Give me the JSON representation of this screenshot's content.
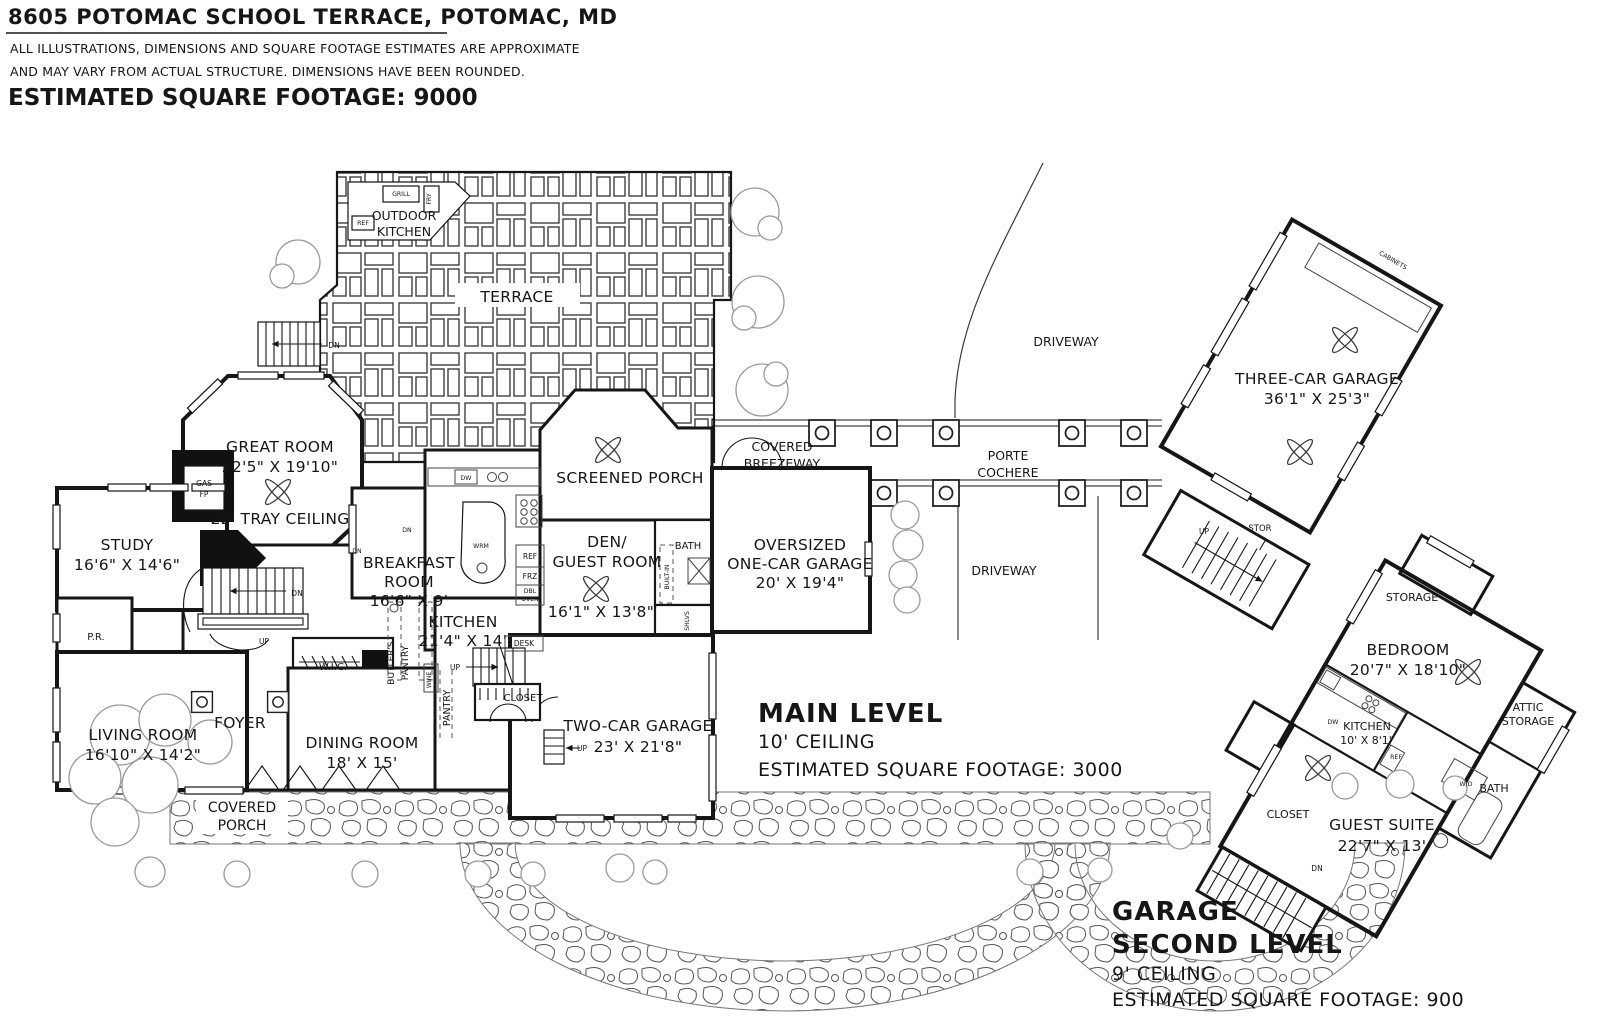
{
  "header": {
    "title": "8605 POTOMAC SCHOOL TERRACE, POTOMAC, MD",
    "disclaimer_line1": "ALL ILLUSTRATIONS, DIMENSIONS AND SQUARE FOOTAGE ESTIMATES ARE APPROXIMATE",
    "disclaimer_line2": "AND MAY VARY FROM ACTUAL STRUCTURE. DIMENSIONS HAVE BEEN ROUNDED.",
    "total_footage": "ESTIMATED SQUARE FOOTAGE: 9000"
  },
  "main_level": {
    "section_title": "MAIN LEVEL",
    "ceiling": "10' CEILING",
    "footage": "ESTIMATED SQUARE FOOTAGE: 3000",
    "rooms": {
      "terrace": {
        "name": "TERRACE"
      },
      "outdoor_kitchen": {
        "line1": "OUTDOOR",
        "line2": "KITCHEN"
      },
      "great_room": {
        "name": "GREAT ROOM",
        "dims": "22'5\" X 19'10\"",
        "note": "22' TRAY CEILING"
      },
      "study": {
        "name": "STUDY",
        "dims": "16'6\" X 14'6\""
      },
      "powder_room": {
        "name": "P.R."
      },
      "living_room": {
        "name": "LIVING ROOM",
        "dims": "16'10\" X 14'2\""
      },
      "foyer": {
        "name": "FOYER"
      },
      "wic": {
        "name": "W.I.C."
      },
      "butlers_pantry": {
        "line1": "BUTLER'S",
        "line2": "PANTRY"
      },
      "pantry": {
        "name": "PANTRY"
      },
      "dining_room": {
        "name": "DINING ROOM",
        "dims": "18' X 15'"
      },
      "covered_porch": {
        "line1": "COVERED",
        "line2": "PORCH"
      },
      "breakfast_room": {
        "line1": "BREAKFAST",
        "line2": "ROOM",
        "dims": "16'6\" X 9'"
      },
      "kitchen": {
        "name": "KITCHEN",
        "dims": "21'4\" X 14'"
      },
      "screened_porch": {
        "name": "SCREENED PORCH"
      },
      "den_guest": {
        "line1": "DEN/",
        "line2": "GUEST ROOM",
        "dims": "16'1\" X 13'8\""
      },
      "bath": {
        "name": "BATH"
      },
      "closet": {
        "name": "CLOSET"
      },
      "two_car_garage": {
        "name": "TWO-CAR GARAGE",
        "dims": "23' X 21'8\""
      },
      "oversized_garage": {
        "line1": "OVERSIZED",
        "line2": "ONE-CAR GARAGE",
        "dims": "20' X 19'4\""
      },
      "covered_breezeway": {
        "line1": "COVERED",
        "line2": "BREEZEWAY"
      },
      "porte_cochere": {
        "line1": "PORTE",
        "line2": "COCHERE"
      },
      "three_car_garage": {
        "name": "THREE-CAR GARAGE",
        "dims": "36'1\" X 25'3\""
      },
      "driveway_upper": {
        "name": "DRIVEWAY"
      },
      "driveway_lower": {
        "name": "DRIVEWAY"
      }
    },
    "fixtures": {
      "gas": "GAS",
      "fp": "FP",
      "grill": "GRILL",
      "fry": "FRY",
      "ref_outdoor": "REF",
      "dw": "DW",
      "wrm": "WRM",
      "ref": "REF",
      "frz": "FRZ",
      "dbl": "DBL",
      "oven": "OVEN",
      "desk": "DESK",
      "wine": "WINE",
      "built_in": "BUILT-IN",
      "shlvs": "SHLVS",
      "cabinets": "CABINETS",
      "stor": "STOR",
      "up": "UP",
      "dn": "DN"
    }
  },
  "garage_second_level": {
    "section_title_line1": "GARAGE",
    "section_title_line2": "SECOND LEVEL",
    "ceiling": "9' CEILING",
    "footage": "ESTIMATED SQUARE FOOTAGE: 900",
    "rooms": {
      "storage": {
        "name": "STORAGE"
      },
      "bedroom": {
        "name": "BEDROOM",
        "dims": "20'7\" X 18'10\""
      },
      "attic_storage": {
        "line1": "ATTIC",
        "line2": "STORAGE"
      },
      "kitchen": {
        "name": "KITCHEN",
        "dims": "10' X 8'1\""
      },
      "closet": {
        "name": "CLOSET"
      },
      "guest_suite": {
        "name": "GUEST SUITE",
        "dims": "22'7\" X 13'"
      },
      "bath": {
        "name": "BATH"
      }
    },
    "fixtures": {
      "wd": "W/D",
      "dw": "DW",
      "ref": "REF",
      "dn": "DN"
    }
  }
}
